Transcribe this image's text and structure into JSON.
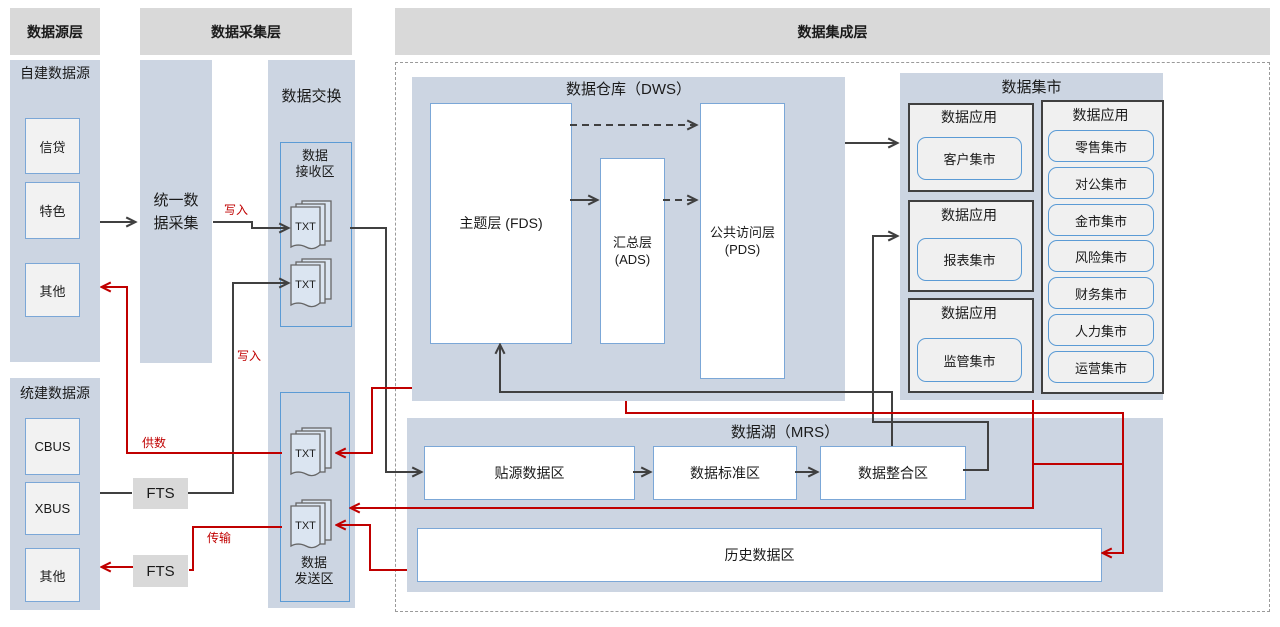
{
  "headers": {
    "source_layer": "数据源层",
    "collection_layer": "数据采集层",
    "integration_layer": "数据集成层"
  },
  "source_self": {
    "title": "自建数据源",
    "items": [
      "信贷",
      "特色",
      "其他"
    ]
  },
  "source_unified": {
    "title": "统建数据源",
    "items": [
      "CBUS",
      "XBUS",
      "其他"
    ]
  },
  "collector": {
    "line1": "统一数",
    "line2": "据采集"
  },
  "exchange": {
    "title": "数据交换",
    "recv_line1": "数据",
    "recv_line2": "接收区",
    "send_line1": "数据",
    "send_line2": "发送区",
    "txt_label": "TXT"
  },
  "fts_label": "FTS",
  "edge_labels": {
    "write_top": "写入",
    "write_bottom": "写入",
    "supply": "供数",
    "transfer": "传输"
  },
  "dws": {
    "title": "数据仓库（DWS）",
    "fds": "主题层 (FDS)",
    "ads_line1": "汇总层",
    "ads_line2": "(ADS)",
    "pds_line1": "公共访问层",
    "pds_line2": "(PDS)"
  },
  "marts": {
    "title": "数据集市",
    "app_title": "数据应用",
    "left": [
      "客户集市",
      "报表集市",
      "监管集市"
    ],
    "right": [
      "零售集市",
      "对公集市",
      "金市集市",
      "风险集市",
      "财务集市",
      "人力集市",
      "运营集市"
    ]
  },
  "mrs": {
    "title": "数据湖（MRS）",
    "zones": [
      "贴源数据区",
      "数据标准区",
      "数据整合区"
    ],
    "history": "历史数据区"
  },
  "colors": {
    "red_flow": "#c00000",
    "black_flow": "#404040",
    "panel_blue": "#ccd5e2",
    "header_gray": "#d9d9d9",
    "box_border_blue": "#7ba7d7"
  }
}
